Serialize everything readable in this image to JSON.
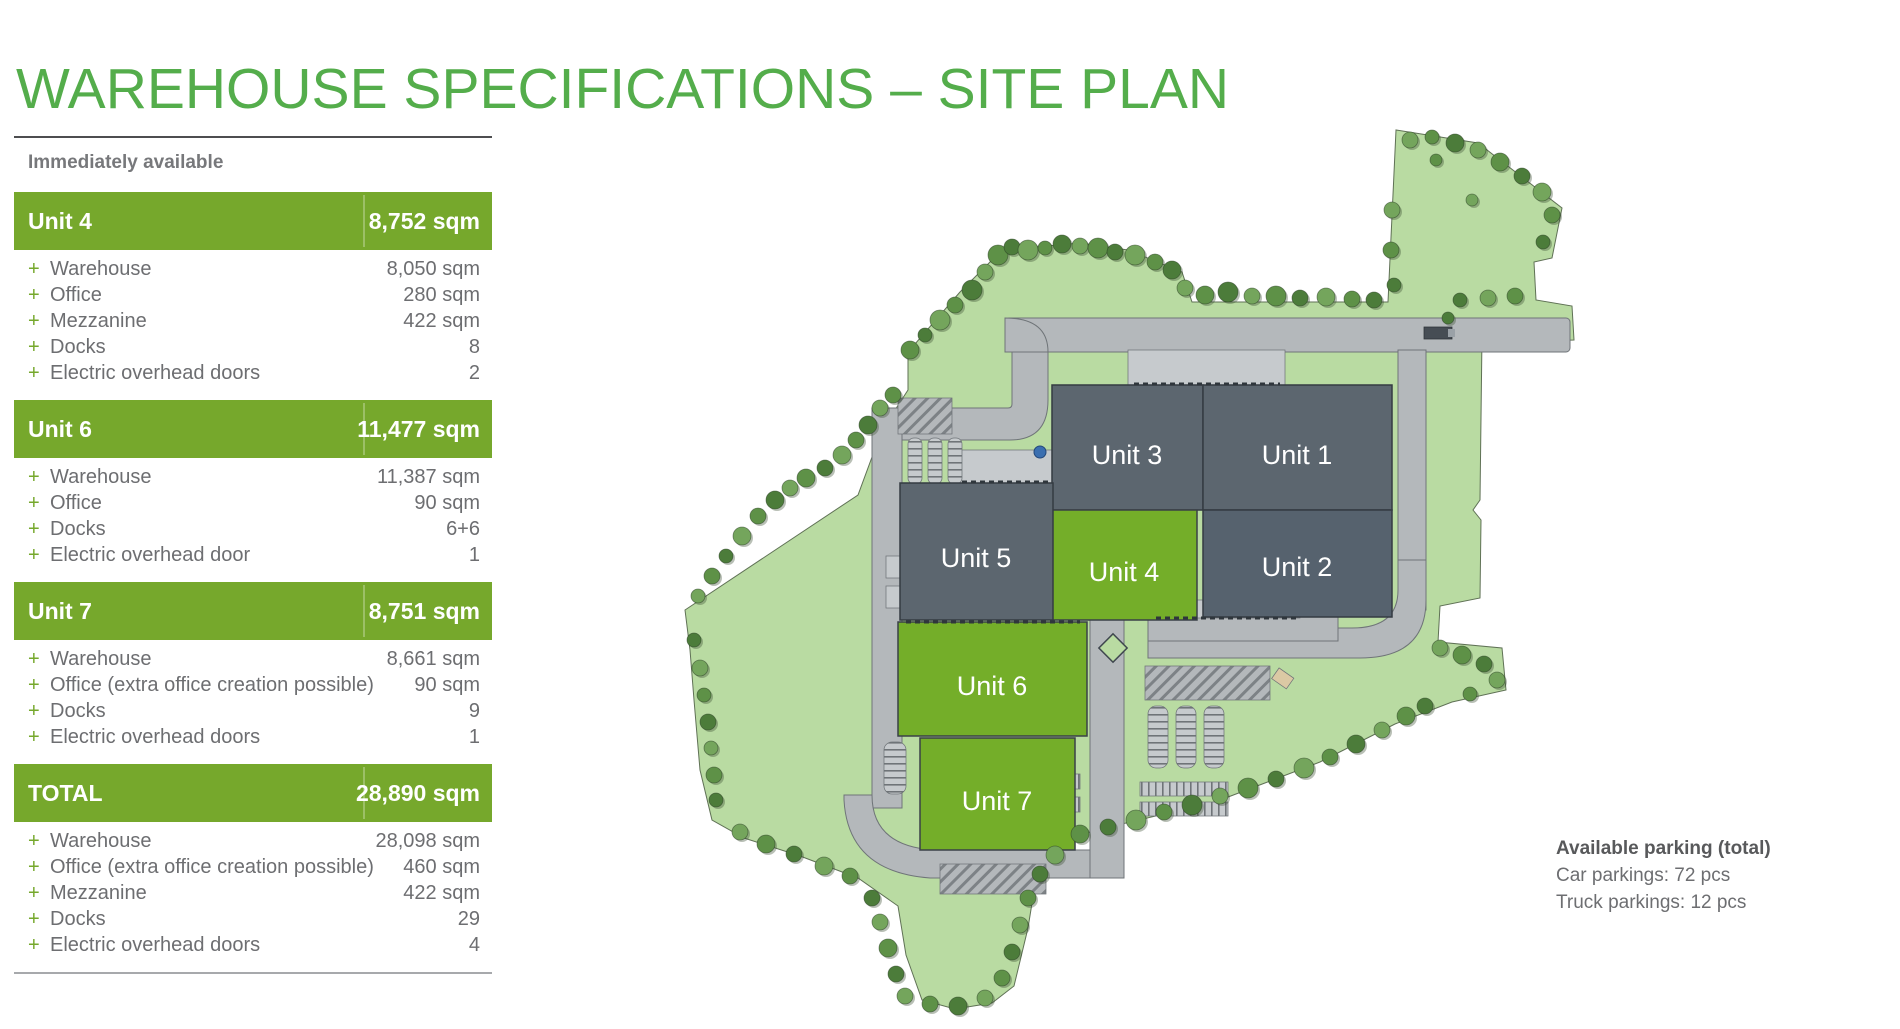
{
  "title": "WAREHOUSE SPECIFICATIONS – SITE PLAN",
  "panel": {
    "header": "Immediately available",
    "bullet": "+",
    "sections": [
      {
        "name": "Unit 4",
        "total": "8,752 sqm",
        "rows": [
          {
            "label": "Warehouse",
            "value": "8,050 sqm"
          },
          {
            "label": "Office",
            "value": "280 sqm"
          },
          {
            "label": "Mezzanine",
            "value": "422 sqm"
          },
          {
            "label": "Docks",
            "value": "8"
          },
          {
            "label": "Electric overhead doors",
            "value": "2"
          }
        ]
      },
      {
        "name": "Unit 6",
        "total": "11,477 sqm",
        "rows": [
          {
            "label": "Warehouse",
            "value": "11,387 sqm"
          },
          {
            "label": "Office",
            "value": "90 sqm"
          },
          {
            "label": "Docks",
            "value": "6+6"
          },
          {
            "label": "Electric overhead door",
            "value": "1"
          }
        ]
      },
      {
        "name": "Unit 7",
        "total": "8,751 sqm",
        "rows": [
          {
            "label": "Warehouse",
            "value": "8,661 sqm"
          },
          {
            "label": "Office (extra office creation possible)",
            "value": "90 sqm"
          },
          {
            "label": "Docks",
            "value": "9"
          },
          {
            "label": "Electric overhead doors",
            "value": "1"
          }
        ]
      },
      {
        "name": "TOTAL",
        "total": "28,890 sqm",
        "rows": [
          {
            "label": "Warehouse",
            "value": "28,098 sqm"
          },
          {
            "label": "Office (extra office creation possible)",
            "value": "460 sqm"
          },
          {
            "label": "Mezzanine",
            "value": "422 sqm"
          },
          {
            "label": "Docks",
            "value": "29"
          },
          {
            "label": "Electric overhead doors",
            "value": "4"
          }
        ]
      }
    ]
  },
  "map": {
    "units": [
      {
        "label": "Unit 3",
        "type": "dark"
      },
      {
        "label": "Unit 1",
        "type": "dark"
      },
      {
        "label": "Unit 2",
        "type": "dark"
      },
      {
        "label": "Unit 4",
        "type": "green"
      },
      {
        "label": "Unit 5",
        "type": "dark"
      },
      {
        "label": "Unit 6",
        "type": "green"
      },
      {
        "label": "Unit 7",
        "type": "green"
      }
    ],
    "parking_note": {
      "title": "Available parking (total)",
      "lines": [
        "Car parkings: 72 pcs",
        "Truck parkings: 12 pcs"
      ]
    }
  },
  "colors": {
    "title_green": "#54ad4b",
    "bar_green": "#76a82c",
    "unit_green": "#74ae29",
    "building_dark": "#5c666f",
    "landscape_green": "#b9dba2",
    "road_gray": "#b4b8bb"
  }
}
